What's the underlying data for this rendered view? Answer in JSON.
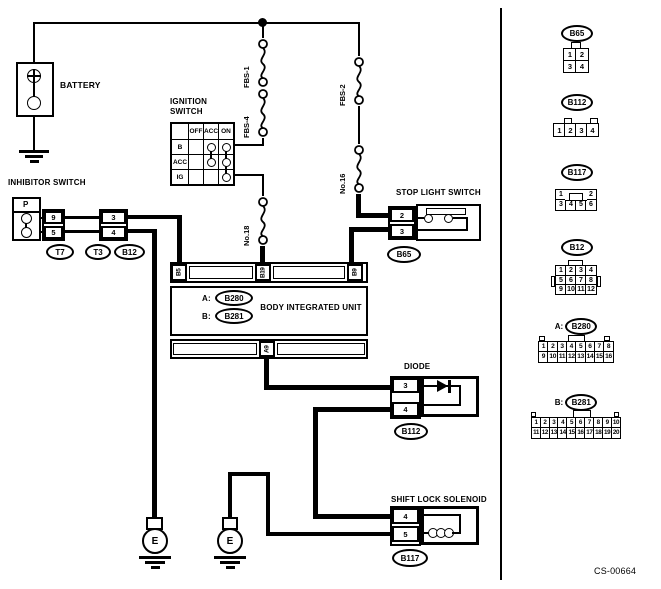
{
  "footer": "CS-00664",
  "battery": {
    "label": "BATTERY"
  },
  "ignition": {
    "title": "IGNITION\nSWITCH",
    "columns": [
      "OFF",
      "ACC",
      "ON"
    ],
    "rows": [
      {
        "label": "B",
        "contacts": [
          0,
          1,
          1
        ]
      },
      {
        "label": "ACC",
        "contacts": [
          0,
          1,
          1
        ]
      },
      {
        "label": "IG",
        "contacts": [
          0,
          0,
          1
        ]
      }
    ]
  },
  "fuses": {
    "fbs1": "FBS-1",
    "fbs4": "FBS-4",
    "no18": "No.18",
    "fbs2": "FBS-2",
    "no16": "No.16"
  },
  "inhibitor": {
    "label": "INHIBITOR SWITCH",
    "gear": "P",
    "pin_top": "9",
    "pin_bottom": "5",
    "conn1": "T7",
    "pin2_top": "3",
    "pin2_bottom": "4",
    "conn2": "T3",
    "conn3": "B12"
  },
  "stoplight": {
    "label": "STOP LIGHT SWITCH",
    "pin_top": "2",
    "pin_bottom": "3",
    "conn": "B65"
  },
  "biu": {
    "label": "BODY INTEGRATED UNIT",
    "a_prefix": "A:",
    "a_label": "B280",
    "b_prefix": "B:",
    "b_label": "B281",
    "pin_b5": "B5",
    "pin_b19": "B19",
    "pin_b9": "B9",
    "pin_a9": "A9"
  },
  "diode": {
    "label": "DIODE",
    "pin_top": "3",
    "pin_bottom": "4",
    "conn": "B112"
  },
  "solenoid": {
    "label": "SHIFT LOCK SOLENOID",
    "pin_top": "4",
    "pin_bottom": "5",
    "conn": "B117"
  },
  "grounds": {
    "left": "E",
    "right": "E"
  },
  "connector_panel": [
    {
      "prefix": "",
      "label": "B65",
      "rows": [
        [
          "1",
          "2"
        ],
        [
          "3",
          "4"
        ]
      ]
    },
    {
      "prefix": "",
      "label": "B112",
      "rows": [
        [
          "1",
          "2",
          "3",
          "4"
        ]
      ]
    },
    {
      "prefix": "",
      "label": "B117",
      "rows": [
        [
          "1",
          "",
          "2"
        ],
        [
          "3",
          "4",
          "5",
          "6"
        ]
      ]
    },
    {
      "prefix": "",
      "label": "B12",
      "rows": [
        [
          "1",
          "2",
          "3",
          "4"
        ],
        [
          "5",
          "6",
          "7",
          "8"
        ],
        [
          "9",
          "10",
          "11",
          "12"
        ]
      ]
    },
    {
      "prefix": "A:",
      "label": "B280",
      "rows": [
        [
          "1",
          "2",
          "3",
          "4",
          "5",
          "6",
          "7",
          "8"
        ],
        [
          "9",
          "10",
          "11",
          "12",
          "13",
          "14",
          "15",
          "16"
        ]
      ]
    },
    {
      "prefix": "B:",
      "label": "B281",
      "rows": [
        [
          "1",
          "2",
          "3",
          "4",
          "5",
          "6",
          "7",
          "8",
          "9",
          "10"
        ],
        [
          "11",
          "12",
          "13",
          "14",
          "15",
          "16",
          "17",
          "18",
          "19",
          "20"
        ]
      ]
    }
  ]
}
